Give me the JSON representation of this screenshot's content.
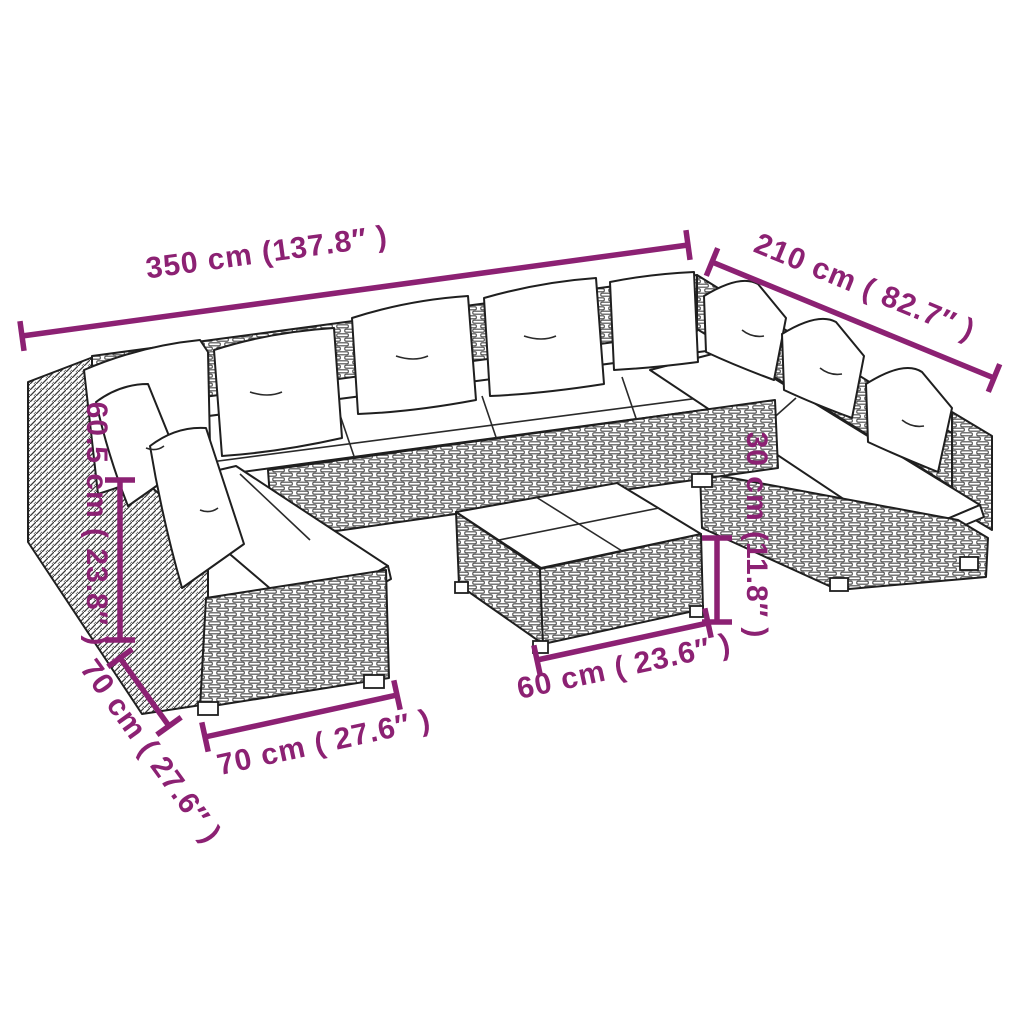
{
  "title": "Rattan garden lounge set dimension diagram",
  "colors": {
    "accent": "#8c2173",
    "line_art": "#1f1f1f",
    "background": "#ffffff"
  },
  "dims": [
    {
      "name": "overall-width",
      "label": "350 cm (137.8″ )"
    },
    {
      "name": "overall-depth",
      "label": "210 cm ( 82.7″ )"
    },
    {
      "name": "back-height",
      "label": "60.5 cm ( 23.8″ )"
    },
    {
      "name": "module-depth",
      "label": "70 cm ( 27.6″ )"
    },
    {
      "name": "module-width",
      "label": "70 cm ( 27.6″ )"
    },
    {
      "name": "table-width",
      "label": "60 cm ( 23.6″ )"
    },
    {
      "name": "table-height",
      "label": "30 cm (11.8″ )"
    }
  ]
}
